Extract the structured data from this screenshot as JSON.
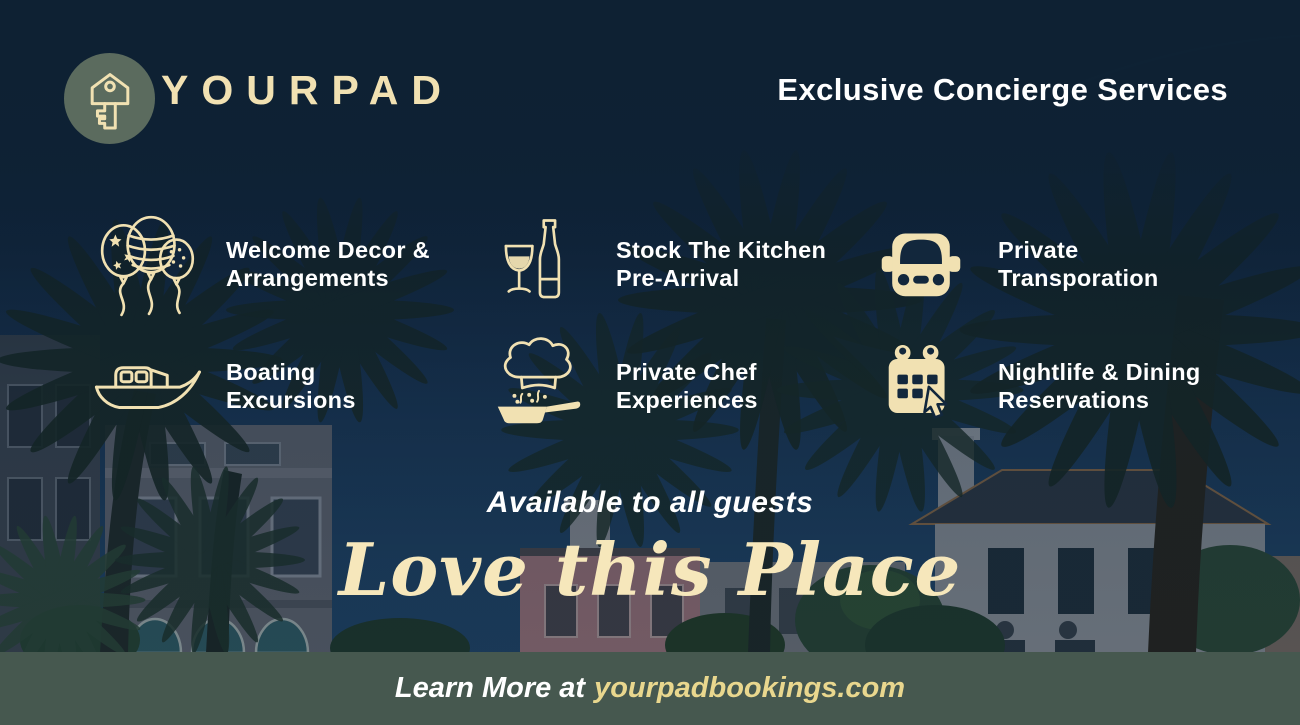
{
  "brand": {
    "name": "YOURPAD",
    "tagline": "Exclusive Concierge Services",
    "logo_icon": "key-icon"
  },
  "services": [
    {
      "icon": "balloons-icon",
      "line1": "Welcome Decor &",
      "line2": "Arrangements"
    },
    {
      "icon": "wine-bottle-glass-icon",
      "line1": "Stock The Kitchen",
      "line2": "Pre-Arrival"
    },
    {
      "icon": "car-icon",
      "line1": "Private",
      "line2": "Transporation"
    },
    {
      "icon": "boat-icon",
      "line1": "Boating",
      "line2": "Excursions"
    },
    {
      "icon": "chef-hat-pan-icon",
      "line1": "Private Chef",
      "line2": "Experiences"
    },
    {
      "icon": "calendar-cursor-icon",
      "line1": "Nightlife & Dining",
      "line2": "Reservations"
    }
  ],
  "banner": {
    "subtitle": "Available to all guests",
    "script_title": "Love this Place"
  },
  "footer": {
    "prefix": "Learn More at",
    "url": "yourpadbookings.com"
  },
  "colors": {
    "navy": "#0e2133",
    "cream": "#f1e1b2",
    "gold": "#e9d78e",
    "footer_green": "#46584f",
    "logo_sage": "#5b6b5e",
    "white": "#ffffff"
  }
}
